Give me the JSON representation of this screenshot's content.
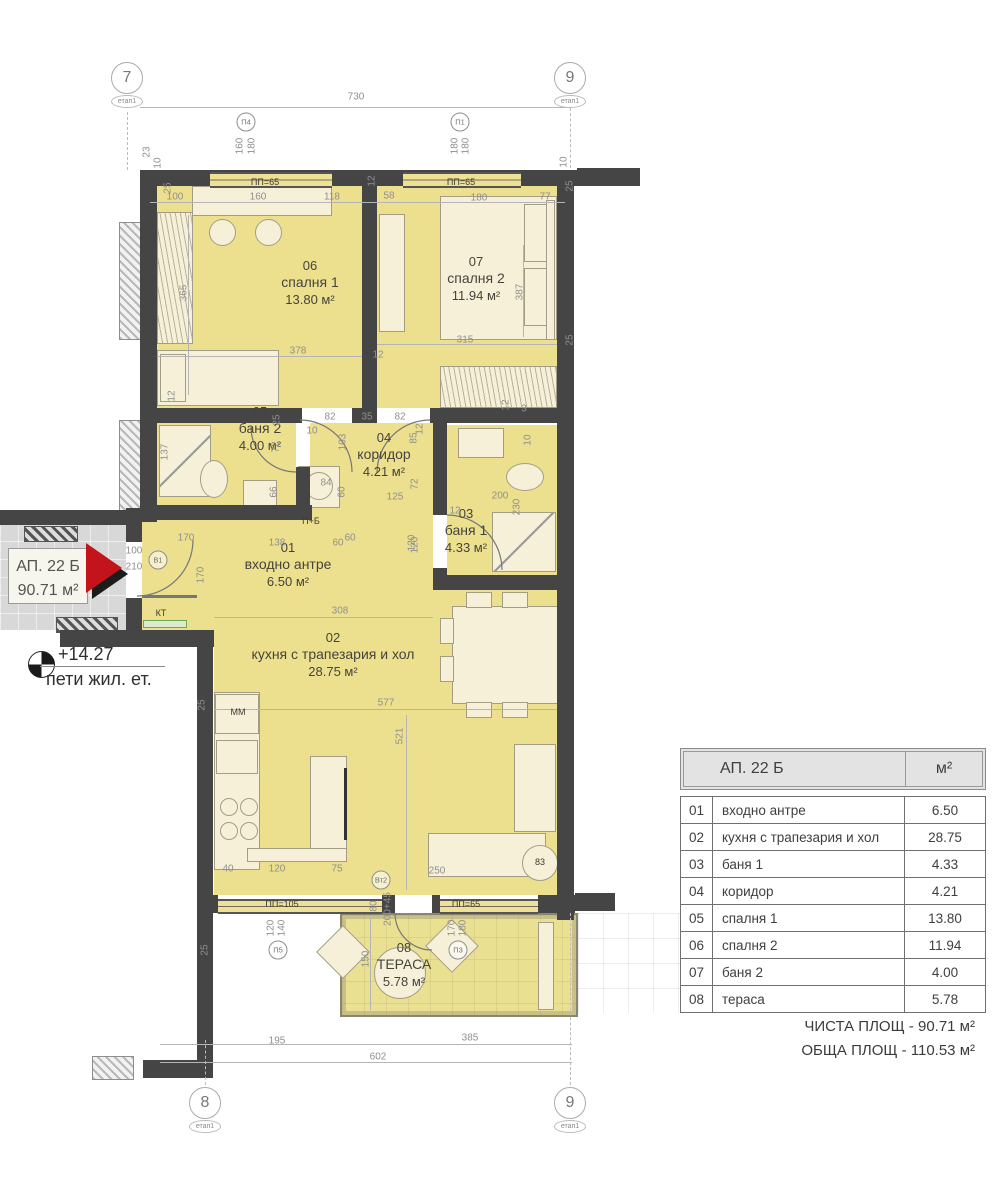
{
  "apartment": {
    "id": "АП. 22 Б",
    "area": "90.71 м²"
  },
  "level": {
    "elevation": "+14.27",
    "floor": "пети жил. ет."
  },
  "grid_markers": [
    {
      "label": "7",
      "stage": "етап1",
      "x": 127,
      "y": 62
    },
    {
      "label": "9",
      "stage": "етап1",
      "x": 570,
      "y": 62
    },
    {
      "label": "8",
      "stage": "етап1",
      "x": 205,
      "y": 1087
    },
    {
      "label": "9",
      "stage": "етап1",
      "x": 570,
      "y": 1087
    }
  ],
  "rooms": [
    {
      "number": "06",
      "name": "спалня 1",
      "area": "13.80 м²",
      "x": 310,
      "y": 258
    },
    {
      "number": "07",
      "name": "спалня 2",
      "area": "11.94 м²",
      "x": 476,
      "y": 254
    },
    {
      "number": "05",
      "name": "баня 2",
      "area": "4.00 м²",
      "x": 260,
      "y": 404
    },
    {
      "number": "04",
      "name": "коридор",
      "area": "4.21 м²",
      "x": 384,
      "y": 430
    },
    {
      "number": "03",
      "name": "баня 1",
      "area": "4.33 м²",
      "x": 466,
      "y": 506
    },
    {
      "number": "01",
      "name": "входно антре",
      "area": "6.50 м²",
      "x": 288,
      "y": 540
    },
    {
      "number": "02",
      "name": "кухня с трапезария и хол",
      "area": "28.75 м²",
      "x": 333,
      "y": 630
    },
    {
      "number": "08",
      "name": "ТЕРАСА",
      "area": "5.78 м²",
      "x": 404,
      "y": 940
    }
  ],
  "door_window_markers": [
    {
      "label": "П4",
      "x": 246,
      "y": 122
    },
    {
      "label": "П1",
      "x": 460,
      "y": 122
    },
    {
      "label": "В1",
      "x": 158,
      "y": 560
    },
    {
      "label": "Вт2",
      "x": 381,
      "y": 880
    },
    {
      "label": "П3",
      "x": 458,
      "y": 950
    },
    {
      "label": "П5",
      "x": 278,
      "y": 950
    }
  ],
  "opening_labels": [
    {
      "text": "ПП=65",
      "x": 265,
      "y": 182
    },
    {
      "text": "ПП=65",
      "x": 461,
      "y": 182
    },
    {
      "text": "ПП=105",
      "x": 282,
      "y": 904
    },
    {
      "text": "ПП=65",
      "x": 466,
      "y": 904
    }
  ],
  "fixture_labels": [
    {
      "text": "КТ",
      "x": 161,
      "y": 613
    },
    {
      "text": "ММ",
      "x": 238,
      "y": 712
    },
    {
      "text": "П+Б",
      "x": 311,
      "y": 521
    },
    {
      "text": "83",
      "x": 540,
      "y": 862
    }
  ],
  "dimensions": [
    {
      "t": "730",
      "x": 356,
      "y": 97
    },
    {
      "t": "23",
      "x": 147,
      "y": 152,
      "v": 1
    },
    {
      "t": "10",
      "x": 158,
      "y": 163,
      "v": 1
    },
    {
      "t": "25",
      "x": 168,
      "y": 188,
      "v": 1
    },
    {
      "t": "100",
      "x": 175,
      "y": 197
    },
    {
      "t": "160",
      "x": 258,
      "y": 197
    },
    {
      "t": "118",
      "x": 332,
      "y": 197
    },
    {
      "t": "12",
      "x": 372,
      "y": 181,
      "v": 1
    },
    {
      "t": "58",
      "x": 389,
      "y": 196
    },
    {
      "t": "180",
      "x": 479,
      "y": 198
    },
    {
      "t": "77",
      "x": 545,
      "y": 197
    },
    {
      "t": "10",
      "x": 564,
      "y": 162,
      "v": 1
    },
    {
      "t": "25",
      "x": 570,
      "y": 186,
      "v": 1
    },
    {
      "t": "160",
      "x": 240,
      "y": 146,
      "v": 1
    },
    {
      "t": "180",
      "x": 252,
      "y": 146,
      "v": 1
    },
    {
      "t": "180",
      "x": 455,
      "y": 146,
      "v": 1
    },
    {
      "t": "180",
      "x": 466,
      "y": 146,
      "v": 1
    },
    {
      "t": "365",
      "x": 184,
      "y": 293,
      "v": 1
    },
    {
      "t": "378",
      "x": 298,
      "y": 351
    },
    {
      "t": "315",
      "x": 465,
      "y": 340
    },
    {
      "t": "387",
      "x": 520,
      "y": 292,
      "v": 1
    },
    {
      "t": "25",
      "x": 570,
      "y": 340,
      "v": 1
    },
    {
      "t": "12",
      "x": 172,
      "y": 396,
      "v": 1
    },
    {
      "t": "82",
      "x": 330,
      "y": 417
    },
    {
      "t": "35",
      "x": 367,
      "y": 417
    },
    {
      "t": "82",
      "x": 400,
      "y": 417
    },
    {
      "t": "12",
      "x": 378,
      "y": 355
    },
    {
      "t": "10",
      "x": 312,
      "y": 431
    },
    {
      "t": "12",
      "x": 420,
      "y": 429,
      "v": 1
    },
    {
      "t": "137",
      "x": 165,
      "y": 452,
      "v": 1
    },
    {
      "t": "25",
      "x": 277,
      "y": 420,
      "v": 1
    },
    {
      "t": "72",
      "x": 276,
      "y": 447,
      "v": 1
    },
    {
      "t": "66",
      "x": 274,
      "y": 492,
      "v": 1
    },
    {
      "t": "84",
      "x": 326,
      "y": 483
    },
    {
      "t": "103",
      "x": 343,
      "y": 442,
      "v": 1
    },
    {
      "t": "60",
      "x": 342,
      "y": 492,
      "v": 1
    },
    {
      "t": "85",
      "x": 414,
      "y": 438,
      "v": 1
    },
    {
      "t": "72",
      "x": 415,
      "y": 484,
      "v": 1
    },
    {
      "t": "125",
      "x": 395,
      "y": 497
    },
    {
      "t": "200",
      "x": 500,
      "y": 496
    },
    {
      "t": "12",
      "x": 455,
      "y": 511
    },
    {
      "t": "230",
      "x": 517,
      "y": 507,
      "v": 1
    },
    {
      "t": "120",
      "x": 415,
      "y": 545,
      "v": 1
    },
    {
      "t": "60",
      "x": 350,
      "y": 538
    },
    {
      "t": "10",
      "x": 528,
      "y": 440,
      "v": 1
    },
    {
      "t": "12",
      "x": 506,
      "y": 405,
      "v": 1
    },
    {
      "t": "3",
      "x": 524,
      "y": 409
    },
    {
      "t": "100",
      "x": 134,
      "y": 551
    },
    {
      "t": "210",
      "x": 134,
      "y": 567
    },
    {
      "t": "170",
      "x": 186,
      "y": 538
    },
    {
      "t": "170",
      "x": 201,
      "y": 575,
      "v": 1
    },
    {
      "t": "138",
      "x": 277,
      "y": 543
    },
    {
      "t": "60",
      "x": 338,
      "y": 543
    },
    {
      "t": "120",
      "x": 412,
      "y": 543,
      "v": 1
    },
    {
      "t": "308",
      "x": 340,
      "y": 611
    },
    {
      "t": "25",
      "x": 202,
      "y": 705,
      "v": 1
    },
    {
      "t": "577",
      "x": 386,
      "y": 703
    },
    {
      "t": "521",
      "x": 400,
      "y": 736,
      "v": 1
    },
    {
      "t": "40",
      "x": 228,
      "y": 869
    },
    {
      "t": "120",
      "x": 277,
      "y": 869
    },
    {
      "t": "75",
      "x": 337,
      "y": 869
    },
    {
      "t": "250",
      "x": 437,
      "y": 871
    },
    {
      "t": "80",
      "x": 374,
      "y": 906,
      "v": 1
    },
    {
      "t": "200+45",
      "x": 388,
      "y": 909,
      "v": 1
    },
    {
      "t": "120",
      "x": 271,
      "y": 928,
      "v": 1
    },
    {
      "t": "140",
      "x": 282,
      "y": 928,
      "v": 1
    },
    {
      "t": "170",
      "x": 452,
      "y": 928,
      "v": 1
    },
    {
      "t": "180",
      "x": 463,
      "y": 928,
      "v": 1
    },
    {
      "t": "150",
      "x": 366,
      "y": 959,
      "v": 1
    },
    {
      "t": "25",
      "x": 205,
      "y": 950,
      "v": 1
    },
    {
      "t": "195",
      "x": 277,
      "y": 1041
    },
    {
      "t": "385",
      "x": 470,
      "y": 1038
    },
    {
      "t": "602",
      "x": 378,
      "y": 1057
    }
  ],
  "legend_table": {
    "header": {
      "title": "АП. 22 Б",
      "unit": "м²"
    },
    "rows": [
      {
        "num": "01",
        "name": "входно антре",
        "value": "6.50"
      },
      {
        "num": "02",
        "name": "кухня с трапезария и хол",
        "value": "28.75"
      },
      {
        "num": "03",
        "name": "баня 1",
        "value": "4.33"
      },
      {
        "num": "04",
        "name": "коридор",
        "value": "4.21"
      },
      {
        "num": "05",
        "name": "спалня 1",
        "value": "13.80"
      },
      {
        "num": "06",
        "name": "спалня 2",
        "value": "11.94"
      },
      {
        "num": "07",
        "name": "баня 2",
        "value": "4.00"
      },
      {
        "num": "08",
        "name": "тераса",
        "value": "5.78"
      }
    ],
    "totals": [
      {
        "label": "ЧИСТА ПЛОЩ",
        "value": "90.71 м²"
      },
      {
        "label": "ОБЩА ПЛОЩ",
        "value": "110.53 м²"
      }
    ]
  },
  "colors": {
    "room_fill": "#ECE08F",
    "wall": "#454545",
    "furniture": "#F6F0D8",
    "accent_red": "#C3131B",
    "commons": "#D8D8D8",
    "dim_text": "#8F8F8F"
  }
}
